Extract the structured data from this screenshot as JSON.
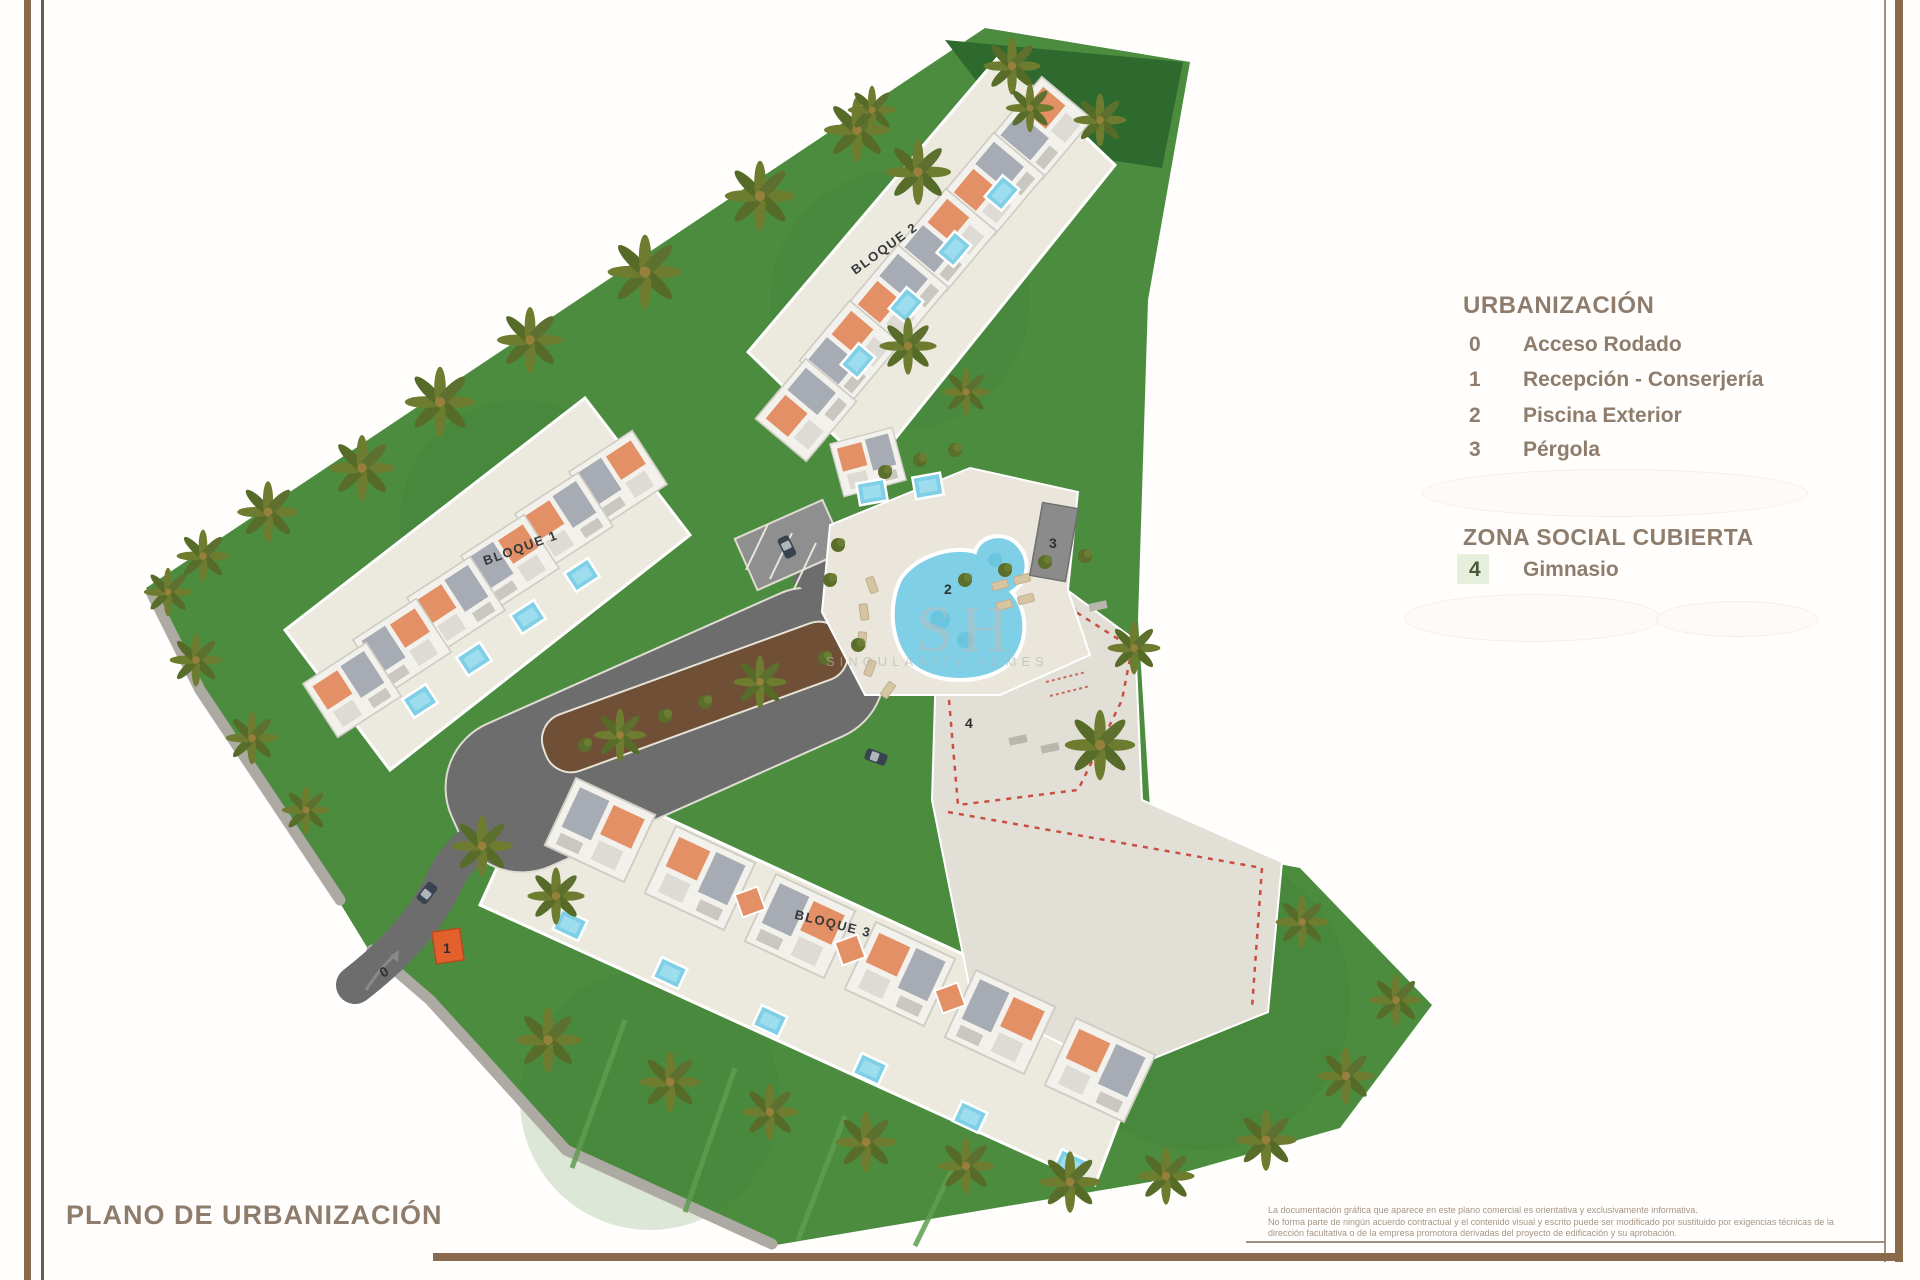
{
  "page": {
    "title": "PLANO DE URBANIZACIÓN"
  },
  "legend": {
    "section1": {
      "title": "URBANIZACIÓN",
      "items": [
        {
          "num": "0",
          "label": "Acceso Rodado"
        },
        {
          "num": "1",
          "label": "Recepción - Conserjería"
        },
        {
          "num": "2",
          "label": "Piscina Exterior"
        },
        {
          "num": "3",
          "label": "Pérgola"
        }
      ]
    },
    "section2": {
      "title": "ZONA SOCIAL CUBIERTA",
      "items": [
        {
          "num": "4",
          "label": "Gimnasio",
          "highlight": true
        }
      ]
    }
  },
  "map": {
    "labels": {
      "b1": "BLOQUE 1",
      "b2": "BLOQUE 2",
      "b3": "BLOQUE 3"
    },
    "markers": {
      "m0": "0",
      "m1": "1",
      "m2": "2",
      "m3": "3",
      "m4": "4"
    }
  },
  "watermark": {
    "logo": "SH",
    "text": "SINGULARITY HOMES"
  },
  "disclaimer": {
    "lines": [
      "La documentación gráfica que aparece en este plano comercial es orientativa y exclusivamente informativa.",
      "No forma parte de ningún acuerdo contractual y el contenido visual y escrito puede ser modificado por sustituido por exigencias técnicas de la",
      "dirección facultativa o de la empresa promotora derivadas del proyecto de edificación y su aprobación."
    ]
  },
  "colors": {
    "frame_brown": "#8a6a4d",
    "legend_text": "#8e7d6d",
    "grass": "#4b8c3f",
    "grass_dark": "#2e6a2e",
    "road": "#6d6d6d",
    "pool_blue": "#7fd0e6",
    "terracotta": "#e49067",
    "roof_gray": "#a7abb3",
    "pavement": "#eae7dd",
    "dashed_red": "#c94f43",
    "marker_orange": "#e2602c"
  }
}
